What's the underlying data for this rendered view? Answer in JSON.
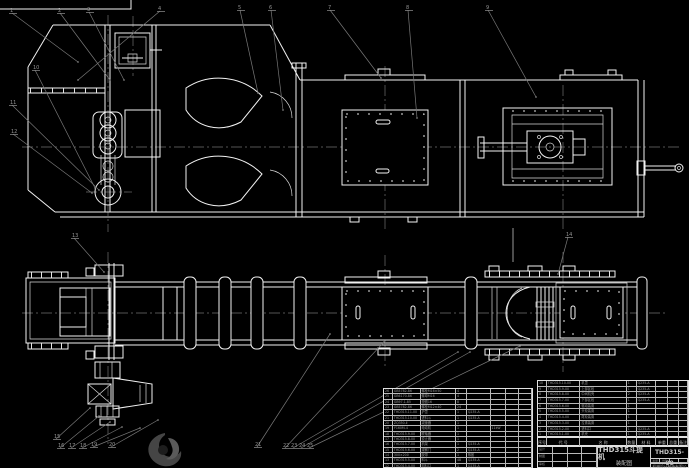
{
  "meta": {
    "description": "CAD assembly drawing, white lines on black background",
    "background": "#000000"
  },
  "colors": {
    "line": "#f2f2f2",
    "leader": "#787878",
    "balloon_text": "#939393",
    "table_text": "#9c9c9c",
    "title_text": "#c9c9c9"
  },
  "title_block": {
    "product": "THD315斗提机",
    "drawing_type": "装配图",
    "drawing_no": "THD315-00",
    "company": "机械设计制造有限公司",
    "sign_grid": [
      [
        "设计",
        "",
        "",
        ""
      ],
      [
        "制图",
        "",
        "",
        ""
      ],
      [
        "审核",
        "",
        "",
        ""
      ]
    ],
    "mini_cells": [
      [
        "重量",
        "比例",
        "",
        ""
      ]
    ]
  },
  "bom_header": [
    [
      "序号",
      "代 号",
      "名 称",
      "数量",
      "材 料",
      "单重",
      "总重",
      "备注"
    ]
  ],
  "bom_left": [
    [
      "26",
      "GB5782-86",
      "螺栓M16×50",
      "4",
      "",
      "",
      "",
      ""
    ],
    [
      "25",
      "GB6170-86",
      "螺母M16",
      "4",
      "",
      "",
      "",
      ""
    ],
    [
      "24",
      "GB97.1-85",
      "垫圈16",
      "8",
      "",
      "",
      "",
      ""
    ],
    [
      "23",
      "GB5782-86",
      "螺栓M12×40",
      "24",
      "",
      "",
      "",
      ""
    ],
    [
      "22",
      "THD315.11-00",
      "护罩",
      "1",
      "Q235-A",
      "",
      "",
      ""
    ],
    [
      "21",
      "THD315.10-00",
      "进料斗",
      "1",
      "Q235-A",
      "",
      "",
      ""
    ],
    [
      "20",
      "ZQ350-Ⅱ",
      "减速器",
      "1",
      "",
      "",
      "",
      ""
    ],
    [
      "19",
      "Y160M-4",
      "电动机",
      "1",
      "",
      "11kW",
      "",
      ""
    ],
    [
      "18",
      "THD315.9-00",
      "联轴器",
      "1",
      "",
      "",
      "",
      ""
    ],
    [
      "17",
      "THD315.8-00",
      "逆止器",
      "1",
      "",
      "",
      "",
      ""
    ],
    [
      "16",
      "THD315.7-00",
      "机架",
      "1",
      "Q235-A",
      "",
      "",
      ""
    ],
    [
      "15",
      "THD315.6-00",
      "观察门",
      "2",
      "Q235-A",
      "",
      "",
      ""
    ],
    [
      "14",
      "300×200",
      "胶带",
      "1",
      "橡胶",
      "",
      "",
      ""
    ],
    [
      "13",
      "THD315.5-00",
      "料斗",
      "48",
      "Q235-A",
      "",
      "",
      ""
    ],
    [
      "12",
      "THD315.4-00",
      "卸料口",
      "1",
      "Q235-A",
      "",
      "",
      ""
    ]
  ],
  "bom_right": [
    [
      "10",
      "THD315.10-00",
      "机罩",
      "1",
      "Q235-A",
      "",
      "",
      ""
    ],
    [
      "9",
      "THD315.9-00",
      "上部区段",
      "1",
      "Q235-A",
      "",
      "",
      ""
    ],
    [
      "8",
      "THD315.8-00",
      "中间机壳",
      "2",
      "Q235-A",
      "",
      "",
      ""
    ],
    [
      "7",
      "THD315.7-00",
      "下部区段",
      "1",
      "Q235-A",
      "",
      "",
      ""
    ],
    [
      "6",
      "THD315.6-00",
      "驱动装置",
      "1",
      "",
      "",
      "",
      ""
    ],
    [
      "5",
      "THD315.5-00",
      "头轮装置",
      "1",
      "",
      "",
      "",
      ""
    ],
    [
      "4",
      "THD315.4-00",
      "尾轮装置",
      "1",
      "",
      "",
      "",
      ""
    ],
    [
      "3",
      "THD315.3-00",
      "拉紧装置",
      "1",
      "",
      "",
      "",
      ""
    ],
    [
      "2",
      "THD315.2-00",
      "进料口",
      "1",
      "Q235-A",
      "",
      "",
      ""
    ],
    [
      "1",
      "THD315.1-00",
      "机壳",
      "1",
      "Q235-A",
      "",
      "",
      ""
    ]
  ],
  "balloons": [
    {
      "n": "1",
      "x": 10,
      "y": 7,
      "lx": 78,
      "ly": 62
    },
    {
      "n": "2",
      "x": 58,
      "y": 7,
      "lx": 110,
      "ly": 80
    },
    {
      "n": "3",
      "x": 87,
      "y": 6,
      "lx": 124,
      "ly": 80
    },
    {
      "n": "4",
      "x": 158,
      "y": 5,
      "lx": 78,
      "ly": 80
    },
    {
      "n": "5",
      "x": 238,
      "y": 4,
      "lx": 258,
      "ly": 93
    },
    {
      "n": "6",
      "x": 269,
      "y": 4,
      "lx": 283,
      "ly": 110
    },
    {
      "n": "7",
      "x": 328,
      "y": 4,
      "lx": 381,
      "ly": 78
    },
    {
      "n": "8",
      "x": 406,
      "y": 4,
      "lx": 417,
      "ly": 118
    },
    {
      "n": "9",
      "x": 486,
      "y": 4,
      "lx": 536,
      "ly": 97
    },
    {
      "n": "10",
      "x": 33,
      "y": 64,
      "lx": 95,
      "ly": 188
    },
    {
      "n": "11",
      "x": 10,
      "y": 99,
      "lx": 99,
      "ly": 190
    },
    {
      "n": "12",
      "x": 11,
      "y": 128,
      "lx": 92,
      "ly": 193
    },
    {
      "n": "13",
      "x": 72,
      "y": 232,
      "lx": 104,
      "ly": 272
    },
    {
      "n": "14",
      "x": 566,
      "y": 231,
      "lx": 558,
      "ly": 274
    },
    {
      "n": "15",
      "x": 54,
      "y": 433,
      "lx": 90,
      "ly": 408
    },
    {
      "n": "16",
      "x": 58,
      "y": 442,
      "lx": 99,
      "ly": 416
    },
    {
      "n": "17",
      "x": 69,
      "y": 442,
      "lx": 110,
      "ly": 422
    },
    {
      "n": "18",
      "x": 80,
      "y": 442,
      "lx": 122,
      "ly": 427
    },
    {
      "n": "19",
      "x": 91,
      "y": 441,
      "lx": 140,
      "ly": 428
    },
    {
      "n": "20",
      "x": 109,
      "y": 441,
      "lx": 158,
      "ly": 420
    },
    {
      "n": "21",
      "x": 255,
      "y": 441,
      "lx": 330,
      "ly": 334
    },
    {
      "n": "22",
      "x": 283,
      "y": 442,
      "lx": 384,
      "ly": 342
    },
    {
      "n": "23",
      "x": 291,
      "y": 442,
      "lx": 458,
      "ly": 352
    },
    {
      "n": "24",
      "x": 299,
      "y": 442,
      "lx": 470,
      "ly": 352
    },
    {
      "n": "25",
      "x": 307,
      "y": 442,
      "lx": 520,
      "ly": 346
    }
  ]
}
